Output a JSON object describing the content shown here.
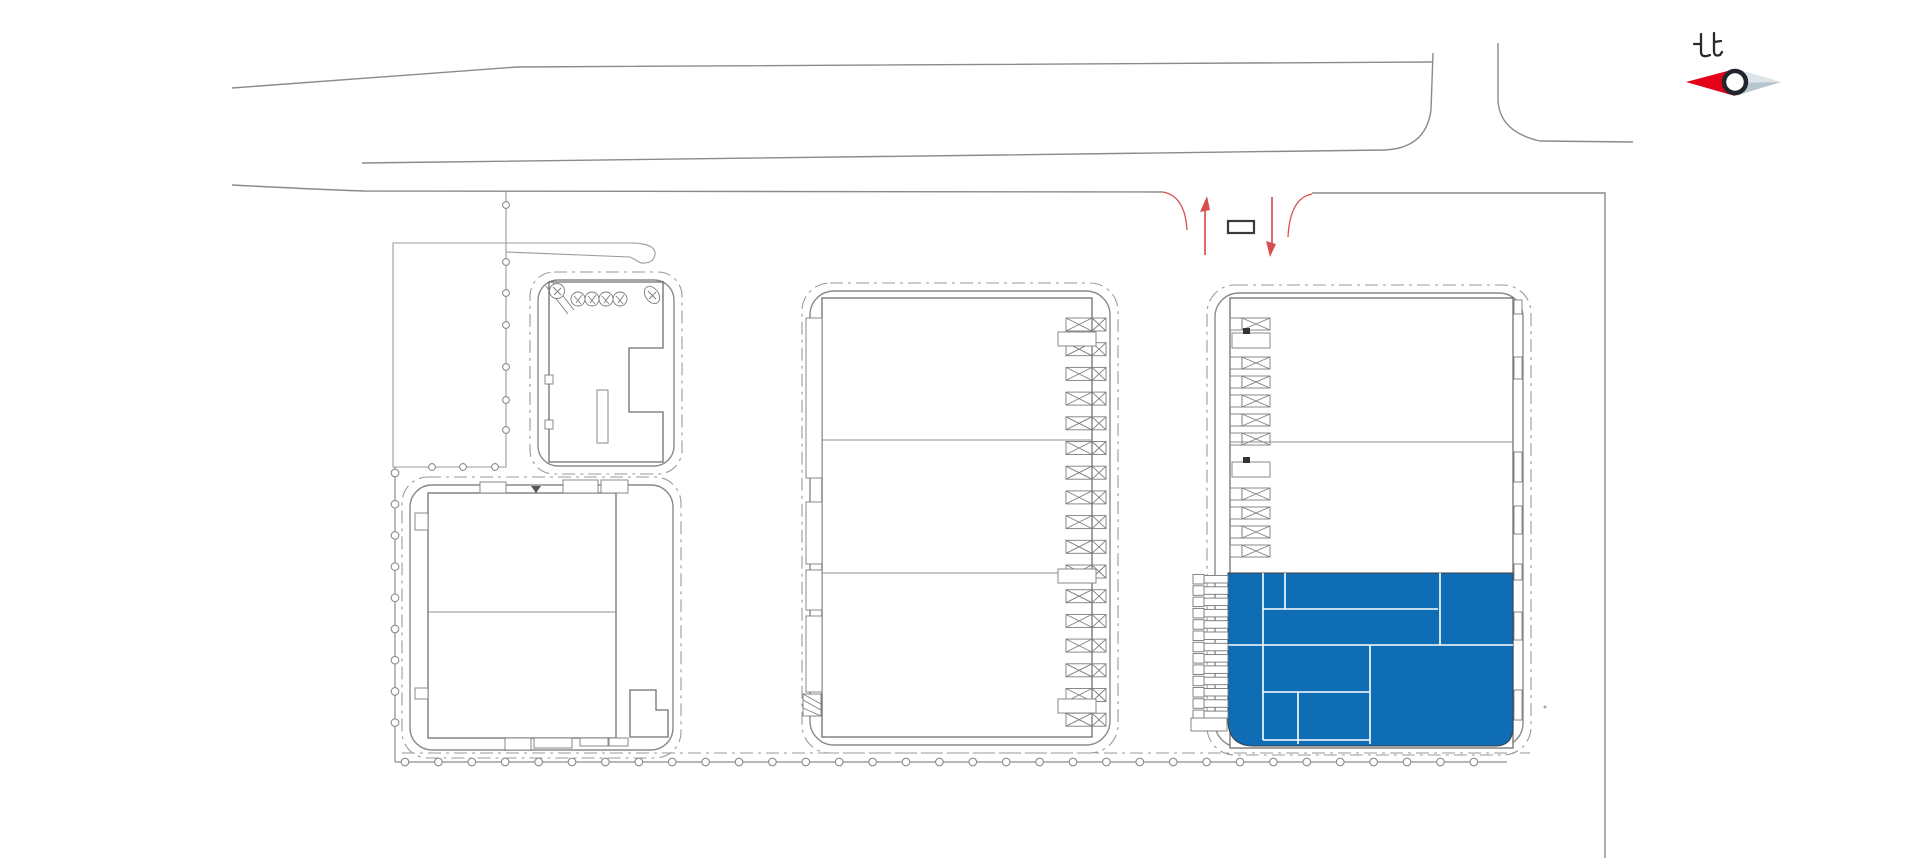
{
  "scene": {
    "background": "#ffffff"
  },
  "compass": {
    "label": "北",
    "needle_red": "#e50019",
    "needle_tail": "#b7c5ce",
    "needle_tail_highlight": "#dde5ea",
    "ring_color": "#20262b"
  },
  "colors": {
    "highlight_blue": "#0e6db5",
    "room_divider": "#ffffff",
    "entrance_red": "#d94f4f",
    "gate_outline": "#3a3a3a",
    "drawing_gray": "#8a8a8a",
    "boundary_dashdot": "#9a9a9a",
    "building_gray": "#6f6f6f",
    "fence_gray": "#8c8c8c"
  }
}
